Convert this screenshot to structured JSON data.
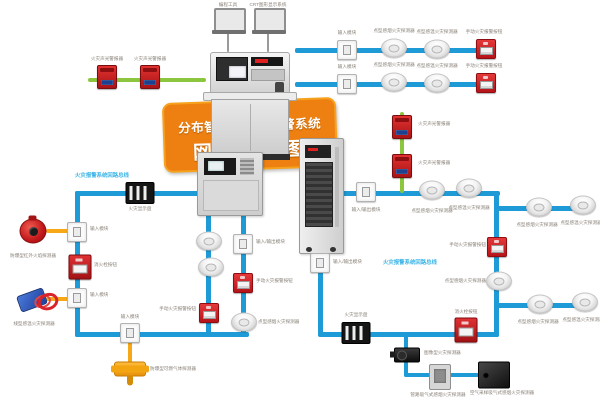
{
  "banner": {
    "line1": "分布智能型火灾报警系统",
    "line2": "网络总线图"
  },
  "colors": {
    "bus": "#1e9ad6",
    "green": "#8cc63e",
    "yellow": "#f6a817",
    "grey": "#9a9a9a",
    "cyan": "#3ab4e6",
    "banner": "#ee7f11",
    "banner_border": "#f6a21d",
    "label": "#8a8178"
  },
  "lines": [
    {
      "x": 295,
      "y": 48,
      "w": 195,
      "h": 5
    },
    {
      "x": 295,
      "y": 82,
      "w": 195,
      "h": 5
    },
    {
      "x": 75,
      "y": 191,
      "w": 125,
      "h": 5
    },
    {
      "x": 75,
      "y": 191,
      "w": 5,
      "h": 146
    },
    {
      "x": 75,
      "y": 332,
      "w": 174,
      "h": 5
    },
    {
      "x": 206,
      "y": 214,
      "w": 5,
      "h": 120
    },
    {
      "x": 241,
      "y": 214,
      "w": 5,
      "h": 120
    },
    {
      "x": 341,
      "y": 191,
      "w": 159,
      "h": 5
    },
    {
      "x": 494,
      "y": 191,
      "w": 5,
      "h": 146
    },
    {
      "x": 494,
      "y": 206,
      "w": 94,
      "h": 5
    },
    {
      "x": 494,
      "y": 303,
      "w": 94,
      "h": 5
    },
    {
      "x": 318,
      "y": 332,
      "w": 181,
      "h": 5
    },
    {
      "x": 318,
      "y": 252,
      "w": 5,
      "h": 82
    },
    {
      "x": 404,
      "y": 335,
      "w": 4,
      "h": 42
    },
    {
      "x": 404,
      "y": 373,
      "w": 92,
      "h": 4
    },
    {
      "x": 88,
      "y": 78,
      "w": 118,
      "h": 4,
      "c": "green"
    },
    {
      "x": 400,
      "y": 112,
      "w": 4,
      "h": 81,
      "c": "green"
    },
    {
      "x": 46,
      "y": 229,
      "w": 30,
      "h": 4,
      "c": "yellow"
    },
    {
      "x": 46,
      "y": 297,
      "w": 30,
      "h": 4,
      "c": "yellow"
    },
    {
      "x": 128,
      "y": 335,
      "w": 4,
      "h": 28,
      "c": "yellow"
    },
    {
      "x": 227,
      "y": 30,
      "w": 2,
      "h": 22,
      "c": "grey"
    },
    {
      "x": 267,
      "y": 30,
      "w": 2,
      "h": 22,
      "c": "grey"
    }
  ],
  "nodes": [
    {
      "t": "alarm",
      "n": "sound-light-alarm",
      "x": 107,
      "y": 77
    },
    {
      "t": "alarm",
      "n": "sound-light-alarm",
      "x": 150,
      "y": 77
    },
    {
      "t": "module",
      "n": "io-module",
      "x": 347,
      "y": 50
    },
    {
      "t": "det",
      "n": "smoke-detector",
      "x": 394,
      "y": 48
    },
    {
      "t": "det",
      "n": "heat-detector",
      "x": 437,
      "y": 49
    },
    {
      "t": "callpoint",
      "n": "manual-call-point",
      "x": 486,
      "y": 49
    },
    {
      "t": "module",
      "n": "io-module",
      "x": 347,
      "y": 84
    },
    {
      "t": "det",
      "n": "smoke-detector",
      "x": 394,
      "y": 82
    },
    {
      "t": "det",
      "n": "heat-detector",
      "x": 437,
      "y": 83
    },
    {
      "t": "callpoint",
      "n": "manual-call-point",
      "x": 486,
      "y": 83
    },
    {
      "t": "display",
      "n": "fire-display-panel",
      "x": 140,
      "y": 193
    },
    {
      "t": "module",
      "n": "input-module",
      "x": 77,
      "y": 232
    },
    {
      "t": "flame",
      "n": "flame-detector",
      "x": 33,
      "y": 231
    },
    {
      "t": "hydrant",
      "n": "hydrant-button",
      "x": 80,
      "y": 267
    },
    {
      "t": "module",
      "n": "input-module",
      "x": 77,
      "y": 298
    },
    {
      "t": "linear",
      "n": "linear-heat-detector",
      "x": 32,
      "y": 300
    },
    {
      "t": "module",
      "n": "input-module",
      "x": 130,
      "y": 333
    },
    {
      "t": "gas",
      "n": "gas-detector",
      "x": 130,
      "y": 369
    },
    {
      "t": "det",
      "n": "smoke-detector",
      "x": 209,
      "y": 241
    },
    {
      "t": "det",
      "n": "smoke-detector",
      "x": 211,
      "y": 267
    },
    {
      "t": "callpoint",
      "n": "manual-call-point",
      "x": 209,
      "y": 313
    },
    {
      "t": "module",
      "n": "io-module",
      "x": 243,
      "y": 244
    },
    {
      "t": "callpoint",
      "n": "manual-call-point",
      "x": 243,
      "y": 283
    },
    {
      "t": "det",
      "n": "smoke-detector",
      "x": 244,
      "y": 322
    },
    {
      "t": "module",
      "n": "io-module",
      "x": 366,
      "y": 192
    },
    {
      "t": "alarm",
      "n": "sound-light-alarm",
      "x": 402,
      "y": 127
    },
    {
      "t": "alarm",
      "n": "sound-light-alarm",
      "x": 402,
      "y": 166
    },
    {
      "t": "det",
      "n": "smoke-detector",
      "x": 432,
      "y": 190
    },
    {
      "t": "det",
      "n": "heat-detector",
      "x": 469,
      "y": 188
    },
    {
      "t": "det",
      "n": "smoke-detector",
      "x": 539,
      "y": 207
    },
    {
      "t": "det",
      "n": "heat-detector",
      "x": 583,
      "y": 205
    },
    {
      "t": "callpoint",
      "n": "manual-call-point",
      "x": 497,
      "y": 247
    },
    {
      "t": "det",
      "n": "smoke-detector",
      "x": 499,
      "y": 281
    },
    {
      "t": "det",
      "n": "smoke-detector",
      "x": 540,
      "y": 304
    },
    {
      "t": "det",
      "n": "heat-detector",
      "x": 585,
      "y": 302
    },
    {
      "t": "module",
      "n": "io-module",
      "x": 320,
      "y": 263
    },
    {
      "t": "display",
      "n": "fire-display-panel",
      "x": 356,
      "y": 333
    },
    {
      "t": "hydrant",
      "n": "hydrant-button",
      "x": 466,
      "y": 330
    },
    {
      "t": "camera",
      "n": "image-fire-detector",
      "x": 407,
      "y": 355
    },
    {
      "t": "greypanel",
      "n": "aspirating-sampling-panel",
      "x": 440,
      "y": 377
    },
    {
      "t": "blackbox",
      "n": "aspirating-detector-unit",
      "x": 494,
      "y": 375
    }
  ],
  "labels": [
    {
      "t": "火灾声光警报器",
      "x": 107,
      "y": 59
    },
    {
      "t": "火灾声光警报器",
      "x": 150,
      "y": 59
    },
    {
      "t": "编程工具",
      "x": 228,
      "y": 5
    },
    {
      "t": "CRT图形显示系统",
      "x": 268,
      "y": 5
    },
    {
      "t": "输入模块",
      "x": 347,
      "y": 33
    },
    {
      "t": "点型感烟火灾探测器",
      "x": 394,
      "y": 31
    },
    {
      "t": "点型感温火灾探测器",
      "x": 437,
      "y": 32
    },
    {
      "t": "手动火灾报警按钮",
      "x": 484,
      "y": 32
    },
    {
      "t": "输入模块",
      "x": 347,
      "y": 67
    },
    {
      "t": "点型感烟火灾探测器",
      "x": 394,
      "y": 65
    },
    {
      "t": "点型感温火灾探测器",
      "x": 437,
      "y": 66
    },
    {
      "t": "手动火灾报警按钮",
      "x": 484,
      "y": 66
    },
    {
      "t": "火灾报警系统回路总线",
      "x": 102,
      "y": 176,
      "c": "cyan"
    },
    {
      "t": "火灾显示盘",
      "x": 140,
      "y": 209
    },
    {
      "t": "输入模块",
      "x": 90,
      "y": 229,
      "a": "l"
    },
    {
      "t": "防爆型红外火焰探测器",
      "x": 33,
      "y": 256
    },
    {
      "t": "消火栓按钮",
      "x": 94,
      "y": 265,
      "a": "l"
    },
    {
      "t": "输入模块",
      "x": 90,
      "y": 295,
      "a": "l"
    },
    {
      "t": "线型感温火灾探测器",
      "x": 34,
      "y": 324
    },
    {
      "t": "输入模块",
      "x": 130,
      "y": 317
    },
    {
      "t": "防爆型可燃气体探测器",
      "x": 150,
      "y": 369,
      "a": "l"
    },
    {
      "t": "手动火灾报警按钮",
      "x": 196,
      "y": 309,
      "a": "r"
    },
    {
      "t": "输入/输出模块",
      "x": 256,
      "y": 242,
      "a": "l"
    },
    {
      "t": "手动火灾报警按钮",
      "x": 256,
      "y": 281,
      "a": "l"
    },
    {
      "t": "点型感烟火灾探测器",
      "x": 258,
      "y": 322,
      "a": "l"
    },
    {
      "t": "输入/输出模块",
      "x": 366,
      "y": 210
    },
    {
      "t": "火灾声光警报器",
      "x": 418,
      "y": 124,
      "a": "l"
    },
    {
      "t": "火灾声光警报器",
      "x": 418,
      "y": 163,
      "a": "l"
    },
    {
      "t": "点型感烟火灾探测器",
      "x": 432,
      "y": 211
    },
    {
      "t": "点型感温火灾探测器",
      "x": 469,
      "y": 208
    },
    {
      "t": "点型感烟火灾探测器",
      "x": 537,
      "y": 225
    },
    {
      "t": "点型感温火灾探测器",
      "x": 581,
      "y": 223
    },
    {
      "t": "手动火灾报警按钮",
      "x": 486,
      "y": 245,
      "a": "r"
    },
    {
      "t": "点型感烟火灾探测器",
      "x": 486,
      "y": 281,
      "a": "r"
    },
    {
      "t": "火灾报警系统回路总线",
      "x": 383,
      "y": 263,
      "a": "l",
      "c": "cyan"
    },
    {
      "t": "点型感烟火灾探测器",
      "x": 538,
      "y": 322
    },
    {
      "t": "点型感温火灾探测器",
      "x": 583,
      "y": 320
    },
    {
      "t": "输入/输出模块",
      "x": 333,
      "y": 262,
      "a": "l"
    },
    {
      "t": "火灾显示盘",
      "x": 356,
      "y": 315
    },
    {
      "t": "消火栓按钮",
      "x": 466,
      "y": 312
    },
    {
      "t": "图像型火灾探测器",
      "x": 424,
      "y": 353,
      "a": "l"
    },
    {
      "t": "管路吸气式感烟火灾探测器",
      "x": 438,
      "y": 395
    },
    {
      "t": "空气采样吸气式感烟火灾探测器",
      "x": 502,
      "y": 393
    }
  ]
}
